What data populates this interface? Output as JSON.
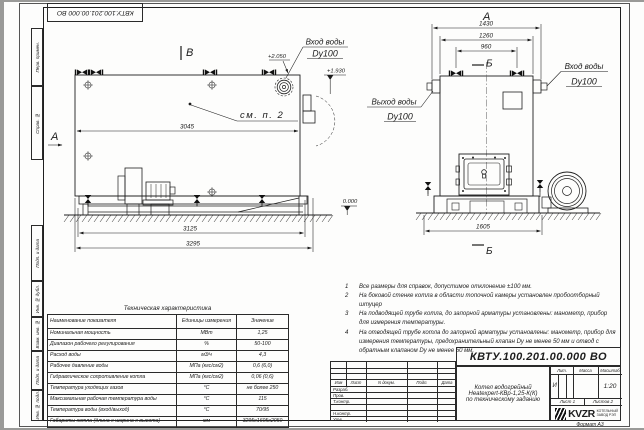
{
  "page": {
    "stamp_top": "КВТУ.100.201.00.000 ВО",
    "format_label": "Формат  А3"
  },
  "frame_labels": {
    "perv": "Перв. примен.",
    "sprav": "Справ. №",
    "podp1": "Подп. и дата",
    "inv_dubl": "Инв. № дубл.",
    "vzam": "Взам. инв. №",
    "podp2": "Подп. и дата",
    "inv_podl": "Инв. № подл."
  },
  "side_view": {
    "label_b": "В",
    "label_a": "А",
    "see_note": "см. п. 2",
    "dim_inner": "3045",
    "dim_mid": "3125",
    "dim_outer": "3295",
    "level_top": "+2.050",
    "level_pipe": "+1.930",
    "level_zero": "0.000",
    "inlet1": "Вход воды",
    "inlet2": "Dy100"
  },
  "front_view": {
    "label_a": "А",
    "label_b_top": "Б",
    "label_b_bottom": "Б",
    "dim_w1": "1430",
    "dim_w2": "1260",
    "dim_w3": "960",
    "dim_base": "1605",
    "inlet1": "Вход воды",
    "inlet2": "Dy100",
    "outlet1": "Выход воды",
    "outlet2": "Dy100"
  },
  "notes": {
    "items": [
      {
        "num": "1",
        "text": "Все размеры для справок, допустимое отклонение ±100 мм."
      },
      {
        "num": "2",
        "text": "На боковой стенке котла в области топочной камеры установлен пробоотборный штуцер"
      },
      {
        "num": "3",
        "text": "На  подводящей трубе котла, до запорной арматуры установлены: манометр, прибор для измерения температуры."
      },
      {
        "num": "4",
        "text": "На отводящей трубе котла до запорной арматуры установлены: манометр, прибор для измерения температуры, предохранительный клапан Dу не менее 50 мм и отвод с обратным клапаном Dу не менее 50 мм."
      }
    ]
  },
  "spec": {
    "title": "Техническая характеристика",
    "col_name": "Наименование показателя",
    "col_units": "Единицы измерения",
    "col_value": "Значение",
    "rows": [
      {
        "name": "Номинальная мощность",
        "units": "МВт",
        "value": "1,25"
      },
      {
        "name": "Диапазон рабочего регулирования",
        "units": "%",
        "value": "50-100"
      },
      {
        "name": "Расход воды",
        "units": "м3/ч",
        "value": "4,3"
      },
      {
        "name": "Рабочее давление воды",
        "units": "МПа (кгс/см2)",
        "value": "0,6 (6,0)"
      },
      {
        "name": "Гидравлическое сопротивление котла",
        "units": "МПа (кгс/см2)",
        "value": "0,06 (0,6)"
      },
      {
        "name": "Температура уходящих газов",
        "units": "°С",
        "value": "не более 250"
      },
      {
        "name": "Максимальная рабочая температура воды",
        "units": "°С",
        "value": "115"
      },
      {
        "name": "Температура воды (вход/выход)",
        "units": "°С",
        "value": "70/95"
      },
      {
        "name": "Габариты котла (длина х ширина х высота)",
        "units": "мм",
        "value": "3295х1605х2050"
      }
    ]
  },
  "tb": {
    "doc_number": "КВТУ.100.201.00.000  ВО",
    "rev": {
      "izm": "Изм",
      "list": "Лист",
      "doc": "N докум.",
      "podp": "Подп.",
      "data": "Дата"
    },
    "signs": {
      "razrab": "Разраб.",
      "prov": "Пров.",
      "tkontr": "Т.контр.",
      "nkontr": "Н.контр.",
      "utv": "Утв."
    },
    "desc1": "Котел водогрейный",
    "desc2": "Heatexpert-КВр-1,25-К(К)",
    "desc3": "по техническому заданию",
    "lit_label": "Лит.",
    "mass_label": "Масса",
    "scale_label": "Масштаб",
    "lit_value": "И",
    "scale_value": "1:20",
    "sheet_label": "Лист  1",
    "sheets_label": "Листов  2",
    "logo": "KVZR",
    "logo_sub1": "КОТЕЛЬНЫЙ",
    "logo_sub2": "ЗАВОД РЭП"
  }
}
